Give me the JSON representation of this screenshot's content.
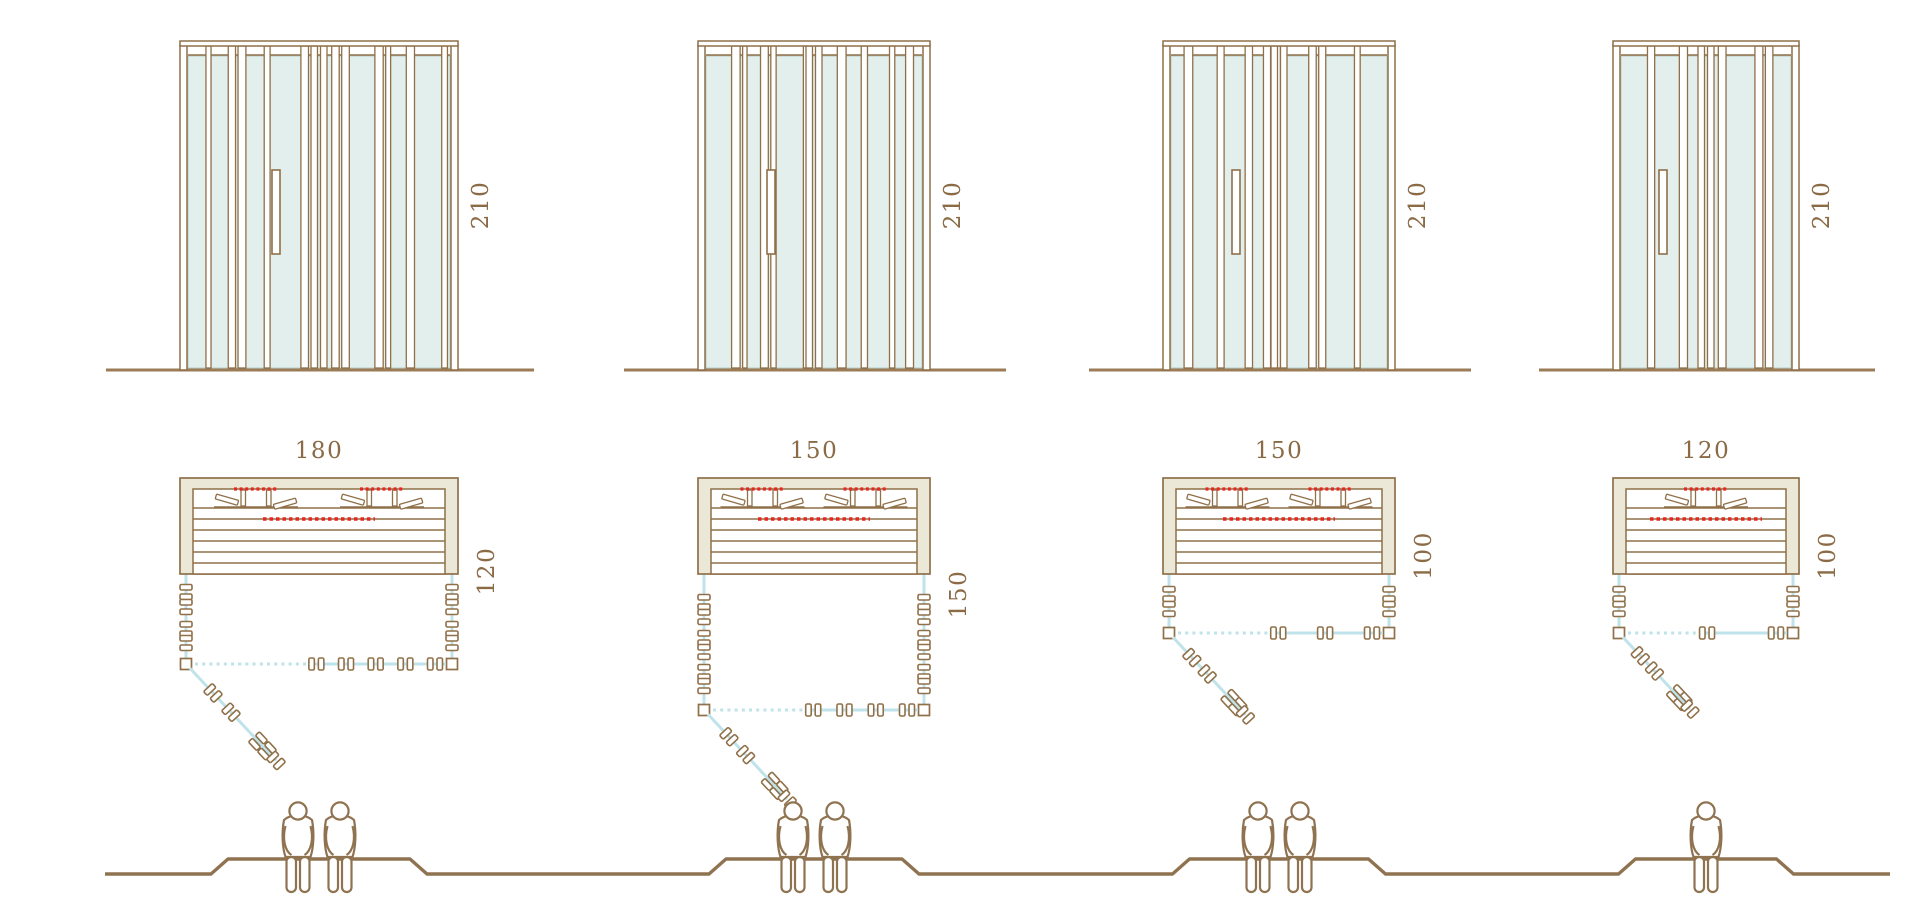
{
  "page": {
    "background": "#ffffff"
  },
  "diagram": {
    "description": "Sauna cabin size comparison: front elevations, floor plans with open glass door, seating sections",
    "height_unit": "cm",
    "cabins": [
      {
        "id": 1,
        "width": "180",
        "depth": "120",
        "height": "210",
        "persons": 2
      },
      {
        "id": 2,
        "width": "150",
        "depth": "150",
        "height": "210",
        "persons": 2
      },
      {
        "id": 3,
        "width": "150",
        "depth": "100",
        "height": "210",
        "persons": 2
      },
      {
        "id": 4,
        "width": "120",
        "depth": "100",
        "height": "210",
        "persons": 1
      }
    ],
    "colors": {
      "wood_outline": "#8f7049",
      "dimension_text": "#8a6b46",
      "wall_fill": "#ece8d7",
      "glass_fill": "#e3efec",
      "glass_line": "#bfe3ea",
      "heater_red": "#e8261f",
      "figure_line": "#8f7350",
      "ground_line": "#9b7c57"
    }
  }
}
